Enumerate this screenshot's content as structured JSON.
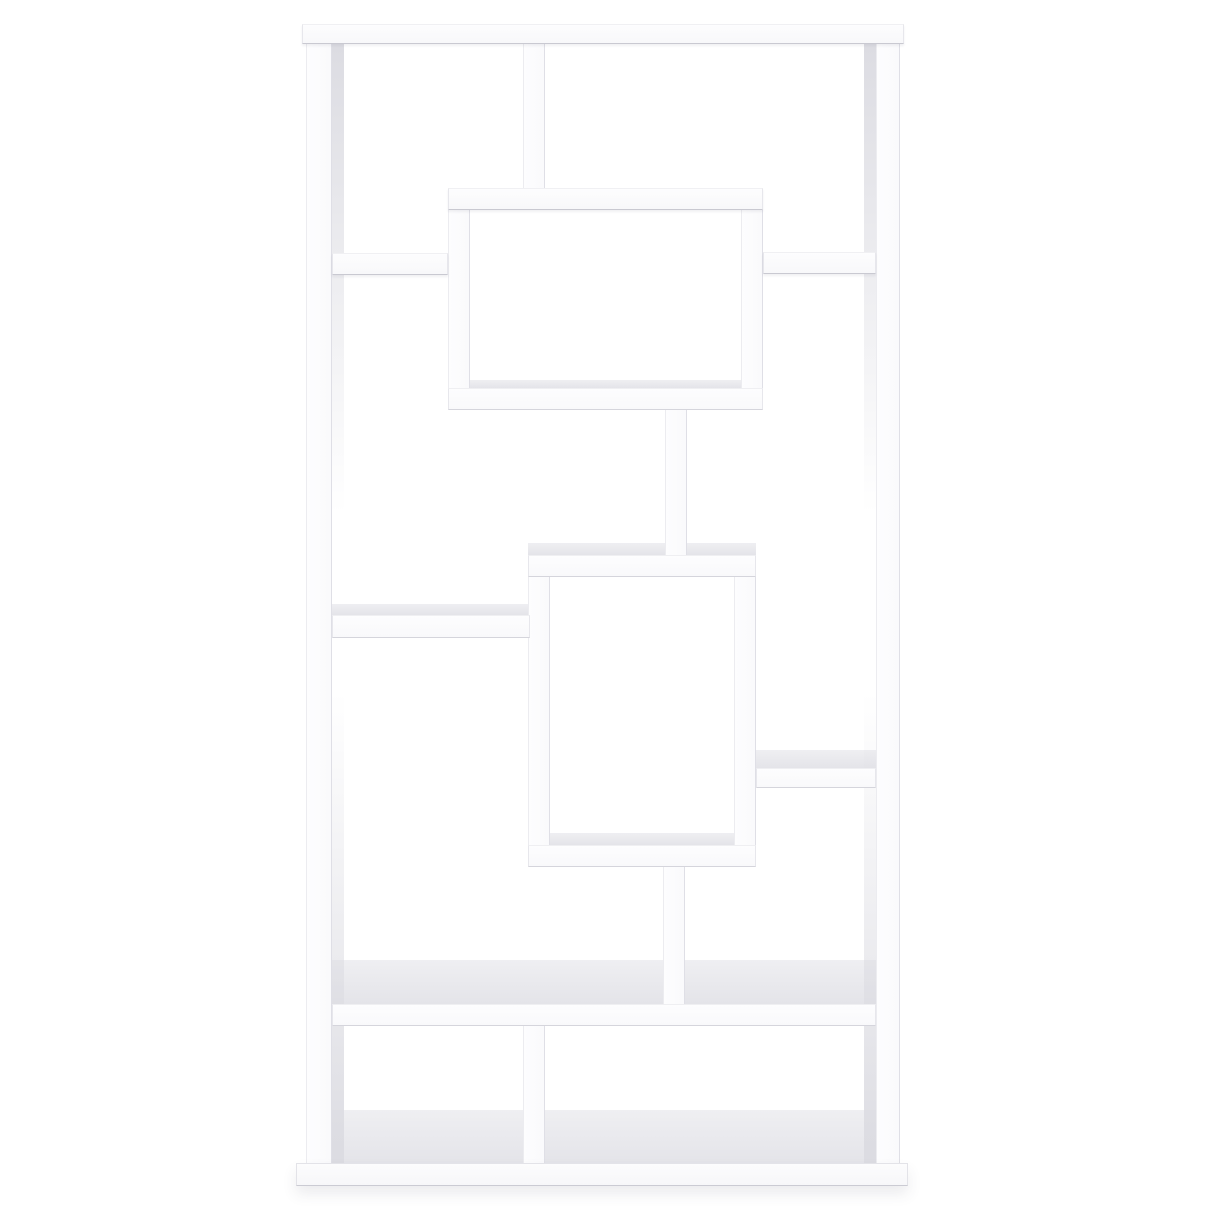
{
  "scene": {
    "description": "Product photo of a white asymmetrical geometric 10-shelf bookcase, straight-on front view, centered on a plain white background",
    "subject": "geometric-cube-bookcase",
    "background_color": "#ffffff",
    "furniture_color": "#fdfdfe",
    "edge_shadow_color": "#d5d5dc",
    "top_surface_color": "#e9e9ed",
    "canvas": {
      "width": 1214,
      "height": 1214
    }
  },
  "members": [
    {
      "name": "upper-box-floor-surface",
      "kind": "band",
      "x": 470,
      "y": 380,
      "w": 271,
      "h": 8
    },
    {
      "name": "lower-box-top-surface",
      "kind": "band",
      "x": 528,
      "y": 543,
      "w": 228,
      "h": 12
    },
    {
      "name": "left-middle-shelf-surface",
      "kind": "band",
      "x": 332,
      "y": 604,
      "w": 198,
      "h": 11
    },
    {
      "name": "right-middle-shelf-surface",
      "kind": "band",
      "x": 756,
      "y": 750,
      "w": 120,
      "h": 18
    },
    {
      "name": "lower-box-floor-surface",
      "kind": "band",
      "x": 550,
      "y": 833,
      "w": 184,
      "h": 12
    },
    {
      "name": "big-shelf-top-surface",
      "kind": "band",
      "x": 332,
      "y": 960,
      "w": 544,
      "h": 44
    },
    {
      "name": "bottom-floor-surface",
      "kind": "band",
      "x": 332,
      "y": 1110,
      "w": 544,
      "h": 53
    },
    {
      "name": "left-stile-inner-face",
      "kind": "sliver",
      "x": 332,
      "y": 44,
      "w": 12,
      "h": 1119
    },
    {
      "name": "right-stile-inner-face",
      "kind": "sliver",
      "x": 864,
      "y": 44,
      "w": 12,
      "h": 1119
    },
    {
      "name": "left-stile",
      "kind": "face-v",
      "x": 306,
      "y": 24,
      "w": 26,
      "h": 1139
    },
    {
      "name": "right-stile",
      "kind": "face-v",
      "x": 876,
      "y": 24,
      "w": 24,
      "h": 1139
    },
    {
      "name": "top-row-divider",
      "kind": "face-v",
      "x": 523,
      "y": 44,
      "w": 22,
      "h": 148
    },
    {
      "name": "upper-box-left-wall",
      "kind": "face-v",
      "x": 448,
      "y": 206,
      "w": 22,
      "h": 184
    },
    {
      "name": "upper-box-right-wall",
      "kind": "face-v",
      "x": 741,
      "y": 206,
      "w": 22,
      "h": 184
    },
    {
      "name": "center-connector-upper",
      "kind": "face-v",
      "x": 665,
      "y": 408,
      "w": 22,
      "h": 148
    },
    {
      "name": "lower-box-left-wall",
      "kind": "face-v",
      "x": 528,
      "y": 575,
      "w": 22,
      "h": 272
    },
    {
      "name": "lower-box-right-wall",
      "kind": "face-v",
      "x": 734,
      "y": 575,
      "w": 22,
      "h": 272
    },
    {
      "name": "center-connector-lower",
      "kind": "face-v",
      "x": 663,
      "y": 865,
      "w": 22,
      "h": 139
    },
    {
      "name": "bottom-row-divider",
      "kind": "face-v",
      "x": 523,
      "y": 1026,
      "w": 22,
      "h": 137
    },
    {
      "name": "top-panel",
      "kind": "face-h-top",
      "x": 302,
      "y": 24,
      "w": 602,
      "h": 20
    },
    {
      "name": "upper-box-top-shelf",
      "kind": "face-h-top",
      "x": 448,
      "y": 188,
      "w": 315,
      "h": 22
    },
    {
      "name": "right-small-shelf",
      "kind": "face-h-top",
      "x": 763,
      "y": 252,
      "w": 113,
      "h": 22
    },
    {
      "name": "left-small-shelf",
      "kind": "face-h-top",
      "x": 332,
      "y": 253,
      "w": 116,
      "h": 22
    },
    {
      "name": "upper-box-bottom-shelf",
      "kind": "face-h",
      "x": 448,
      "y": 388,
      "w": 315,
      "h": 22
    },
    {
      "name": "lower-box-top-shelf",
      "kind": "face-h",
      "x": 528,
      "y": 555,
      "w": 228,
      "h": 22
    },
    {
      "name": "left-middle-shelf",
      "kind": "face-h",
      "x": 332,
      "y": 615,
      "w": 198,
      "h": 23
    },
    {
      "name": "right-middle-shelf",
      "kind": "face-h",
      "x": 756,
      "y": 768,
      "w": 120,
      "h": 20
    },
    {
      "name": "lower-box-bottom-shelf",
      "kind": "face-h",
      "x": 528,
      "y": 845,
      "w": 228,
      "h": 22
    },
    {
      "name": "big-shelf",
      "kind": "face-h",
      "x": 332,
      "y": 1004,
      "w": 544,
      "h": 22
    },
    {
      "name": "base-plinth",
      "kind": "plinth",
      "x": 296,
      "y": 1163,
      "w": 612,
      "h": 23
    }
  ]
}
